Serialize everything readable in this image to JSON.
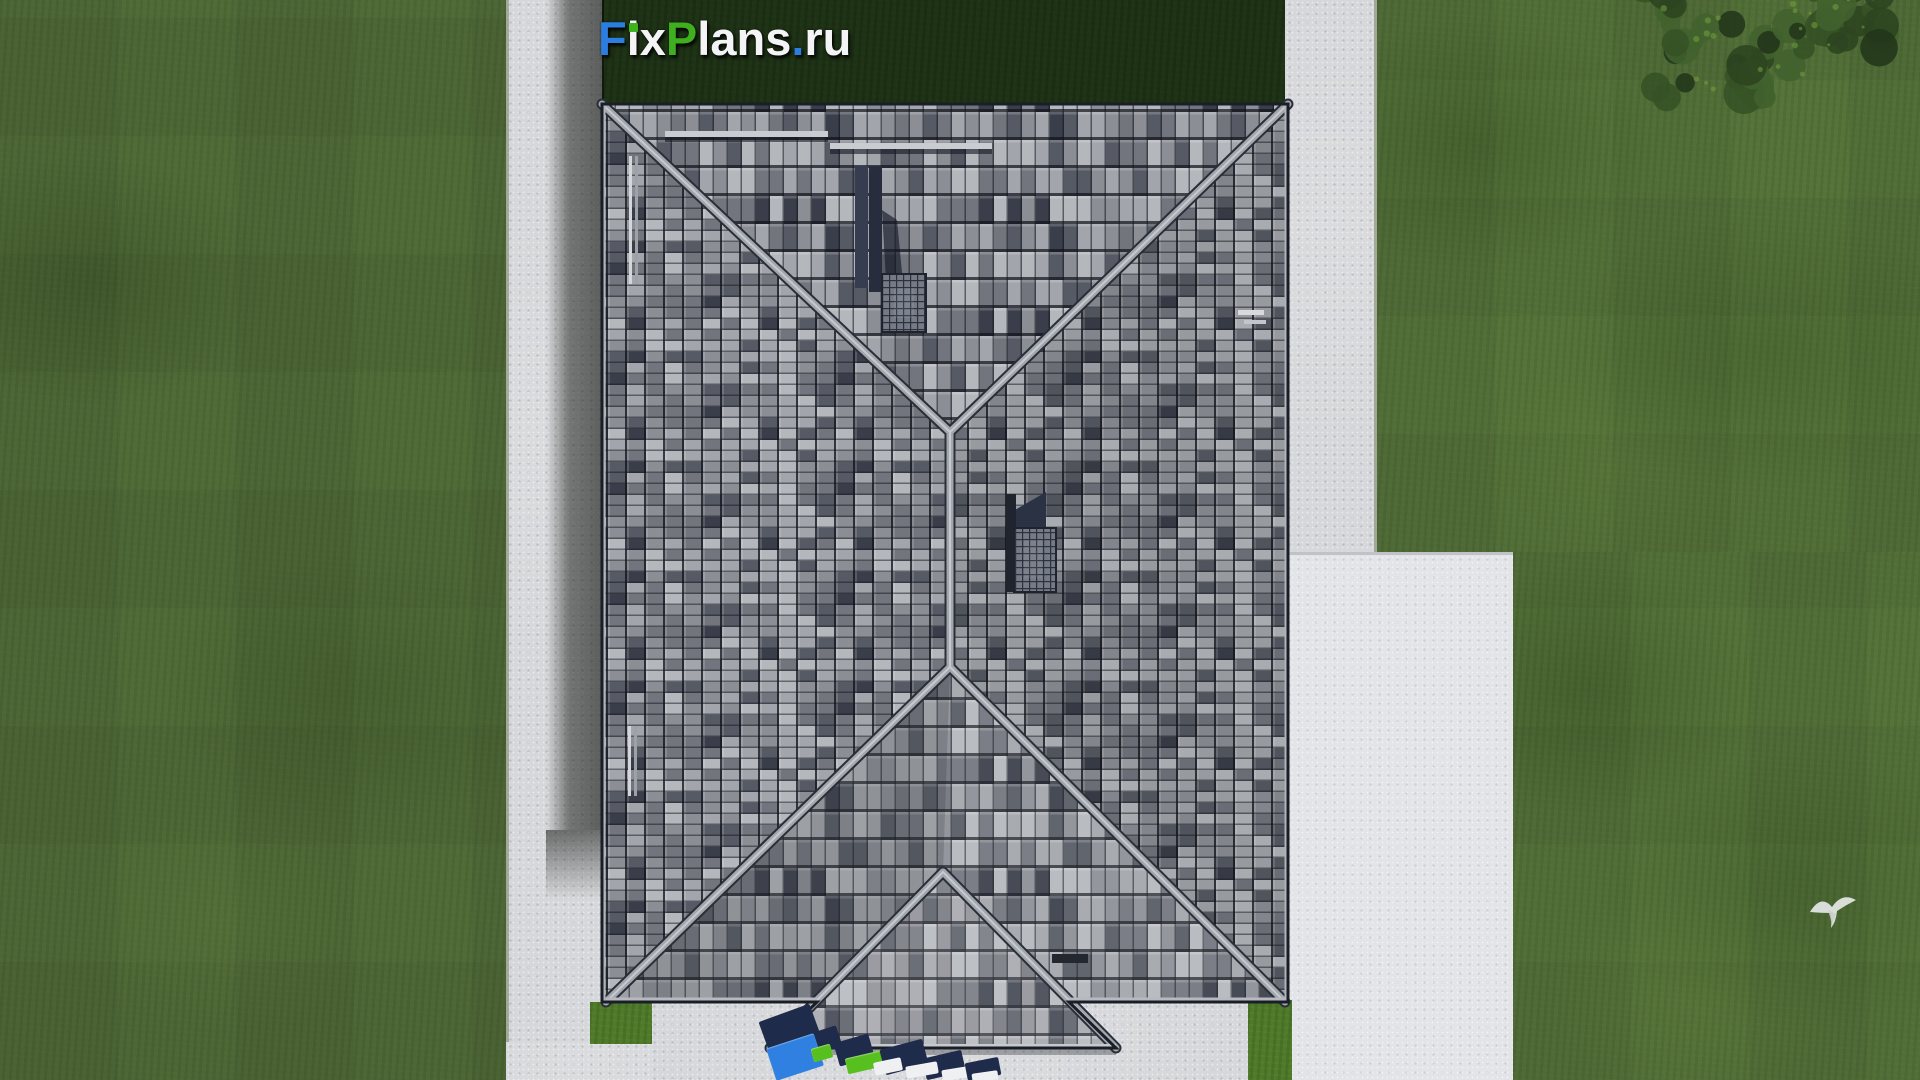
{
  "brand": {
    "name": "FixPlans.ru",
    "segments": [
      {
        "text": "F",
        "color": "#2b7de0"
      },
      {
        "text": "i",
        "color": "#f4f4f6",
        "dot_color": "#3fb31f"
      },
      {
        "text": "x",
        "color": "#f4f4f6"
      },
      {
        "text": "P",
        "color": "#3fae1f"
      },
      {
        "text": "lans",
        "color": "#f4f4f6"
      },
      {
        "text": ".",
        "color": "#2b7de0"
      },
      {
        "text": "ru",
        "color": "#f4f4f6"
      }
    ]
  },
  "watermark": {
    "text": "FixPlans.ru",
    "style": "3d ground logo, cut off at bottom edge of render",
    "colors": {
      "shadow": "#1f2b4a",
      "blue": "#2f80e0",
      "green": "#57c01f",
      "white": "#eef0f2"
    }
  },
  "scene": {
    "type": "aerial-architectural-render",
    "subject": "top-down view of hip-roof house with tiled gray roof, surrounding lawn, paved paths and terrace",
    "colors": {
      "lawn": "#55733a",
      "yard_lawn_dark": "#2c421f",
      "pavement": "#d6d7da",
      "terrace": "#e3e4e7",
      "roof_tile_light": "#b4b7bc",
      "roof_tile_mid": "#8b8e95",
      "roof_tile_dark": "#3a3e4a",
      "ridge_cap": "#a2a7ae",
      "chimney": "#2b3243",
      "bird": "#e6e8e7",
      "tree_foliage": "#2c4420"
    },
    "elements": [
      "hip-roof",
      "ridge-caps",
      "two-chimneys",
      "porch-gable",
      "snow-guard-rails",
      "roof-pipes",
      "terrace-pad",
      "walkways",
      "tree",
      "flying-bird",
      "house-shadow"
    ]
  }
}
